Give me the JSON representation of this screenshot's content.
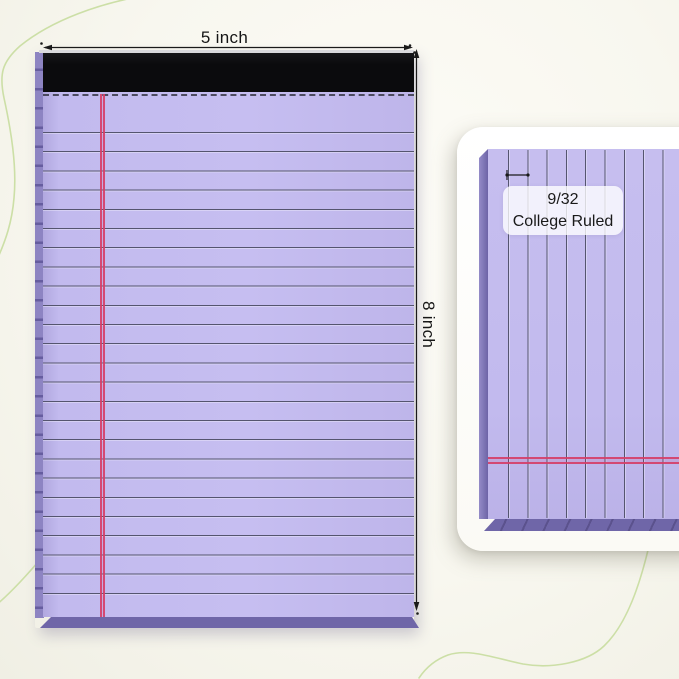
{
  "front_view": {
    "width_label": "5 inch",
    "height_label": "8 inch"
  },
  "detail_view": {
    "ruling_label_line1": "9/32",
    "ruling_label_line2": "College Ruled"
  },
  "colors": {
    "paper": "#c2baee",
    "ruling_line": "#55556f",
    "margin_line": "#d53e67",
    "binding": "#0b0b0d",
    "spine": "#6f66a8",
    "card": "#ffffff",
    "background": "#f8f7ef",
    "accent_curve": "#c9dda2",
    "annotation": "#1a1a1a"
  }
}
